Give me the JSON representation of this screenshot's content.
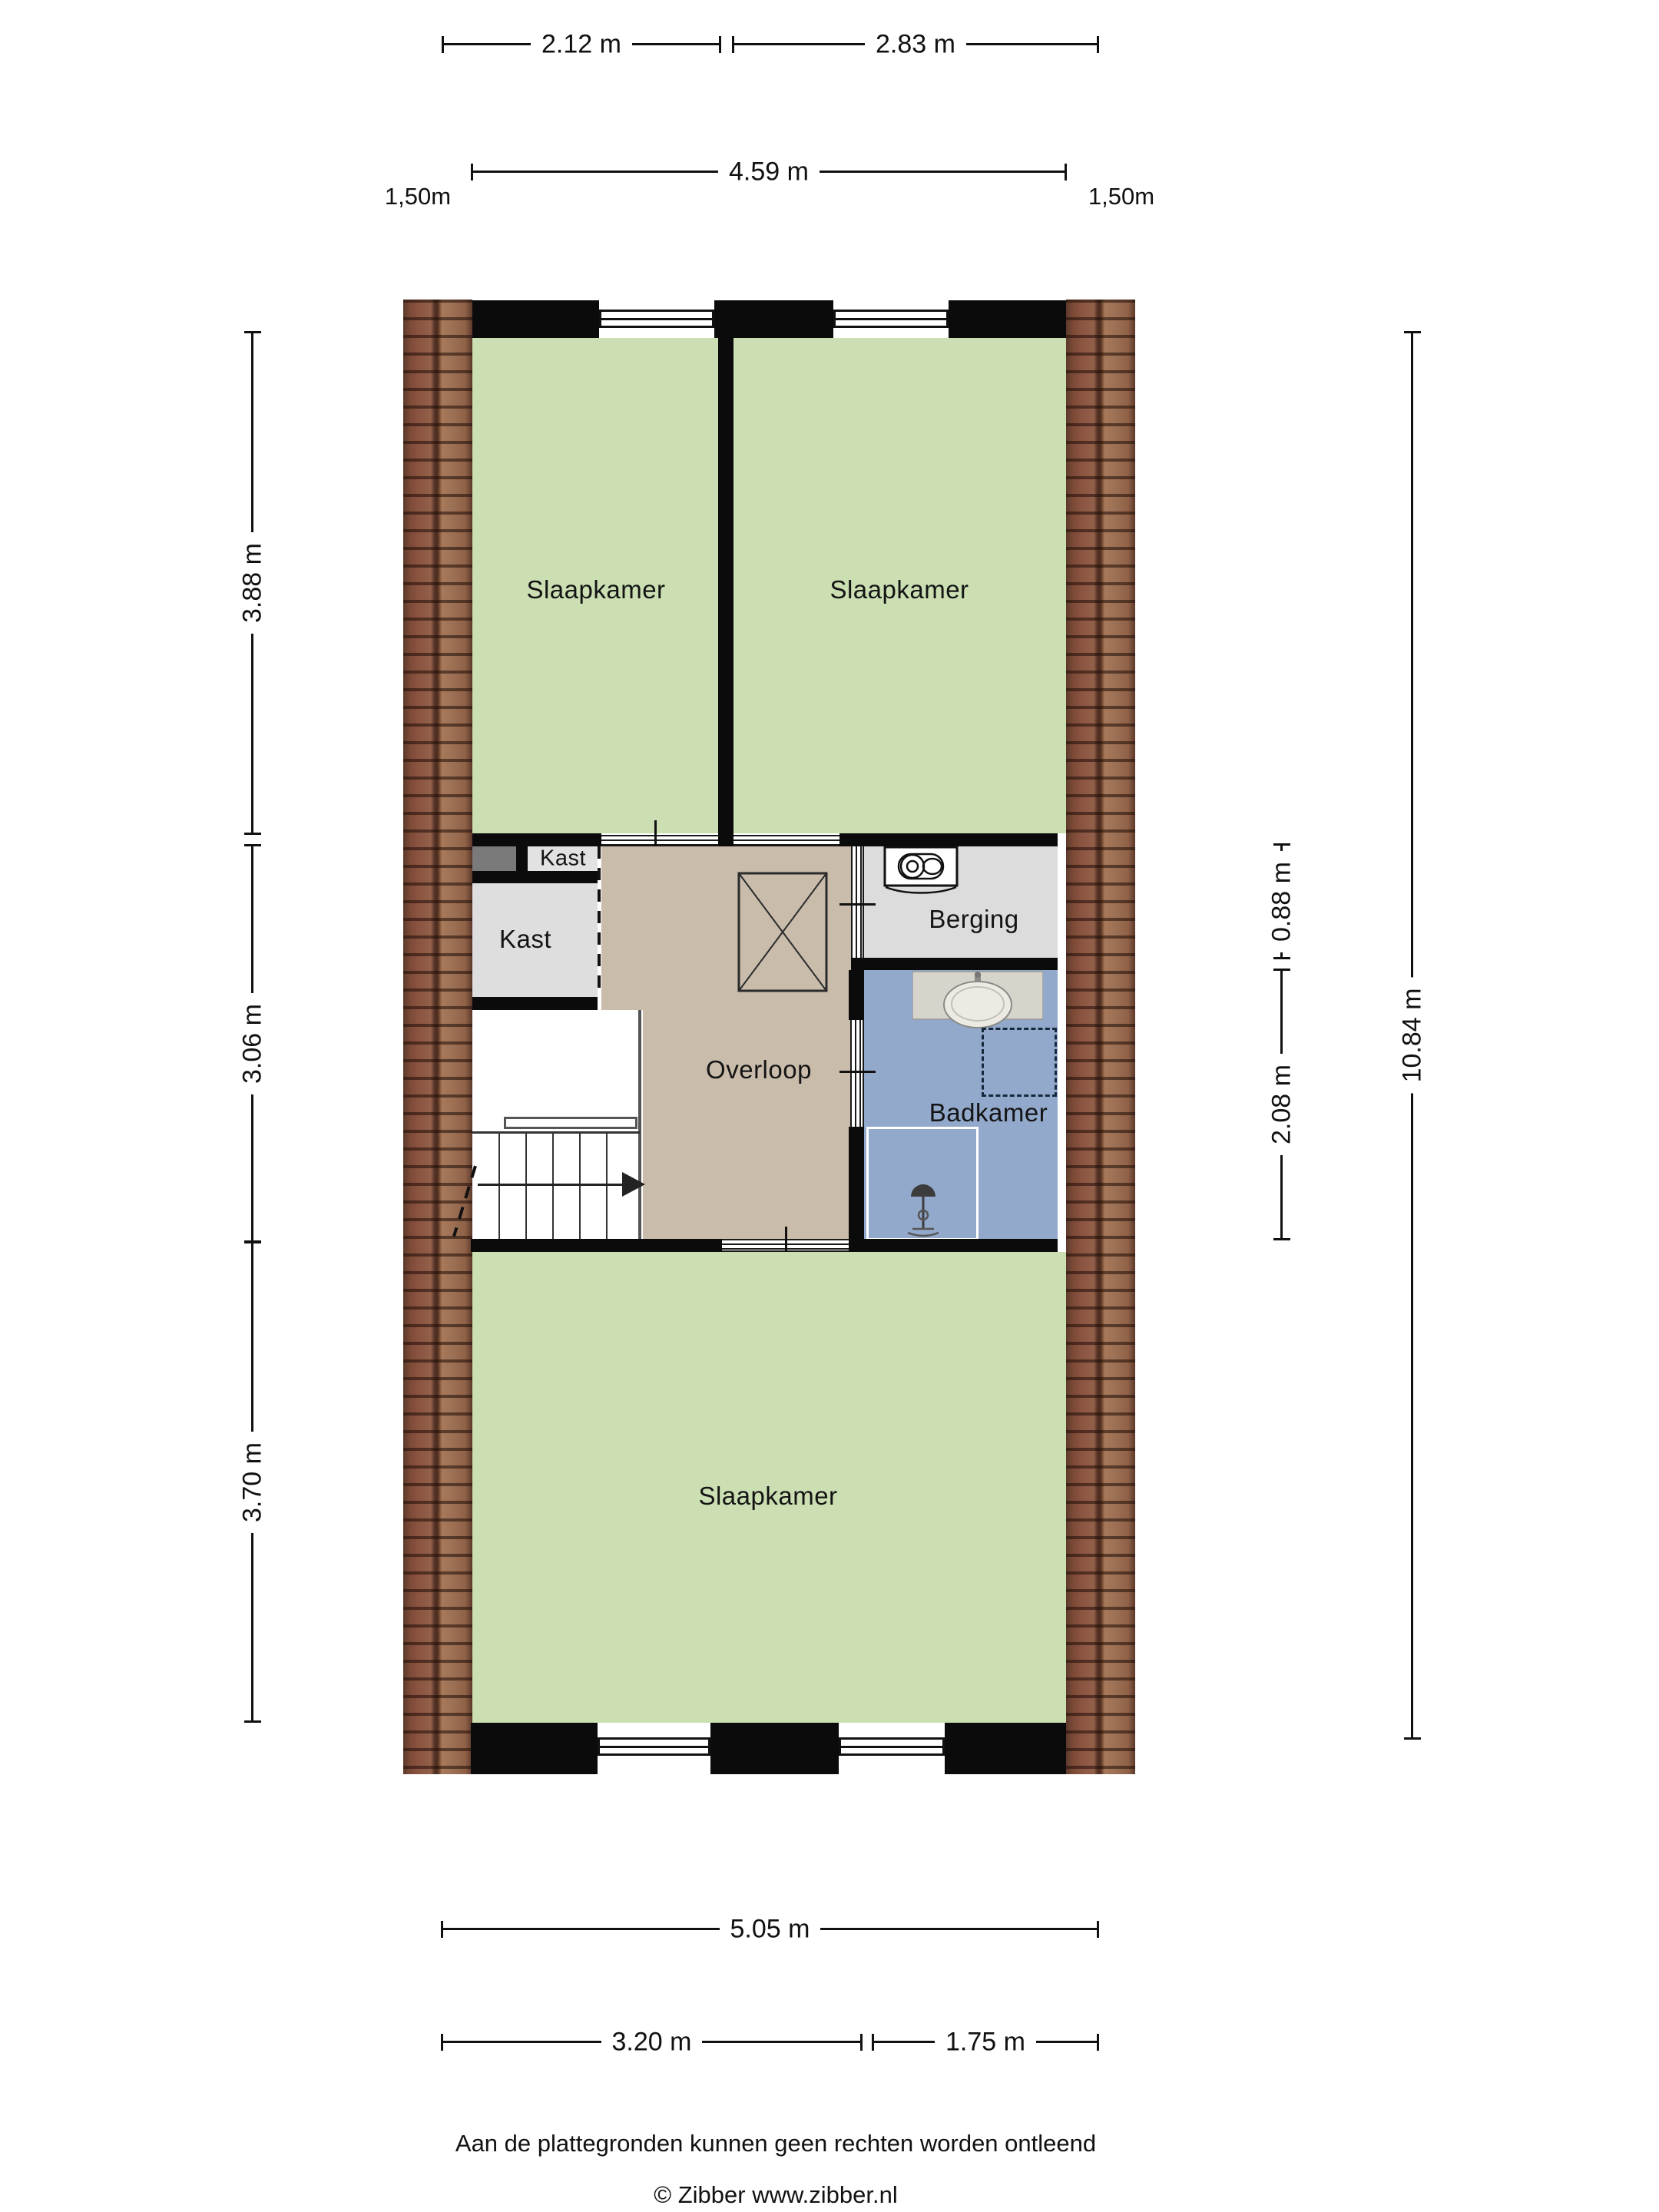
{
  "palette": {
    "bedroom_floor": "#cbdfb2",
    "landing_floor": "#c9bcab",
    "closet_floor": "#dedede",
    "storage_floor": "#dcdcdc",
    "bathroom_floor": "#92a9cb",
    "wall": "#0b0b0b",
    "roof_tile_dark": "#5c392b",
    "roof_tile_light": "#a8795a",
    "accent_gray": "#7a7a7a"
  },
  "rooms": {
    "slaapkamer_tl": {
      "label": "Slaapkamer"
    },
    "slaapkamer_tr": {
      "label": "Slaapkamer"
    },
    "kast_klein": {
      "label": "Kast"
    },
    "kast": {
      "label": "Kast"
    },
    "overloop": {
      "label": "Overloop"
    },
    "berging": {
      "label": "Berging"
    },
    "badkamer": {
      "label": "Badkamer"
    },
    "slaapkamer_groot": {
      "label": "Slaapkamer"
    }
  },
  "dimensions": {
    "top": [
      {
        "label": "2.12 m"
      },
      {
        "label": "2.83 m"
      },
      {
        "label": "4.59 m"
      }
    ],
    "eaves": [
      {
        "label": "1,50m"
      },
      {
        "label": "1,50m"
      }
    ],
    "left": [
      {
        "label": "3.88 m"
      },
      {
        "label": "3.06 m"
      },
      {
        "label": "3.70 m"
      }
    ],
    "right": [
      {
        "label": "0.88 m"
      },
      {
        "label": "2.08 m"
      },
      {
        "label": "10.84 m"
      }
    ],
    "bottom": [
      {
        "label": "5.05 m"
      },
      {
        "label": "3.20 m"
      },
      {
        "label": "1.75 m"
      }
    ]
  },
  "icons": {
    "washer": "washing-machine-icon",
    "sink": "sink-icon",
    "shower": "shower-icon",
    "void_cross": "void-cross-icon",
    "stairs_arrow": "stairs-direction-arrow"
  },
  "footer": {
    "disclaimer": "Aan de plattegronden kunnen geen rechten worden ontleend",
    "credit": "© Zibber www.zibber.nl"
  }
}
